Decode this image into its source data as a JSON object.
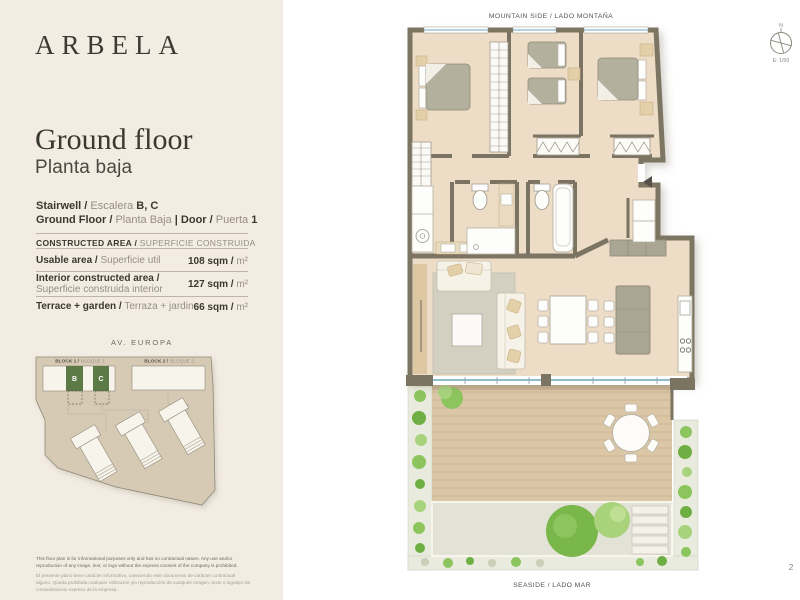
{
  "sidebar": {
    "logo": "ARBELA",
    "title_en": "Ground floor",
    "title_es": "Planta baja",
    "unit": {
      "stairwell_en": "Stairwell /",
      "stairwell_es": "Escalera",
      "stairwell_value": "B, C",
      "floor_en": "Ground Floor /",
      "floor_es": "Planta Baja",
      "separator": "|",
      "door_en": "Door /",
      "door_es": "Puerta",
      "door_value": "1"
    },
    "area_table": {
      "header_en": "CONSTRUCTED AREA /",
      "header_es": "SUPERFICIE CONSTRUIDA",
      "rows": [
        {
          "label_en": "Usable area /",
          "label_es": "Superficie util",
          "value": "108 sqm /",
          "unit": "m²"
        },
        {
          "label_en": "Interior constructed area /",
          "label_es": "Superficie construida interior",
          "value": "127 sqm /",
          "unit": "m²"
        },
        {
          "label_en": "Terrace + garden /",
          "label_es": "Terraza + jardin",
          "value": "66 sqm /",
          "unit": "m²"
        }
      ]
    },
    "site_plan": {
      "street": "AV. EUROPA",
      "block1_en": "BLOCK 1 /",
      "block1_es": "BLOQUE 1",
      "block2_en": "BLOCK 2 /",
      "block2_es": "BLOQUE 2",
      "unit_b": "B",
      "unit_c": "C"
    },
    "disclaimer_en": "This floor plan is for informational purposes only and has no contractual nature. Any use and/or reproduction of any image, text, or logo without the express consent of the company is prohibited.",
    "disclaimer_es": "El presente plano tiene carácter informativo, careciendo este documento de carácter contractual alguno. Queda prohibida cualquier utilización y/o reproducción de cualquier imagen, texto o logotipo sin consentimiento expreso de la empresa."
  },
  "plan": {
    "mountain_label": "MOUNTAIN SIDE / LADO MONTAÑA",
    "seaside_label": "SEASIDE / LADO MAR",
    "compass_north": "N",
    "scale_label": "E: 1/50",
    "page_number": "2"
  },
  "colors": {
    "sidebar_bg": "#f2ece2",
    "wall": "#7b7462",
    "floor": "#eddcc6",
    "accent_green": "#5c7a45",
    "glass": "#8fbccd",
    "text_dark": "#3a392f",
    "text_light": "#968f82"
  }
}
